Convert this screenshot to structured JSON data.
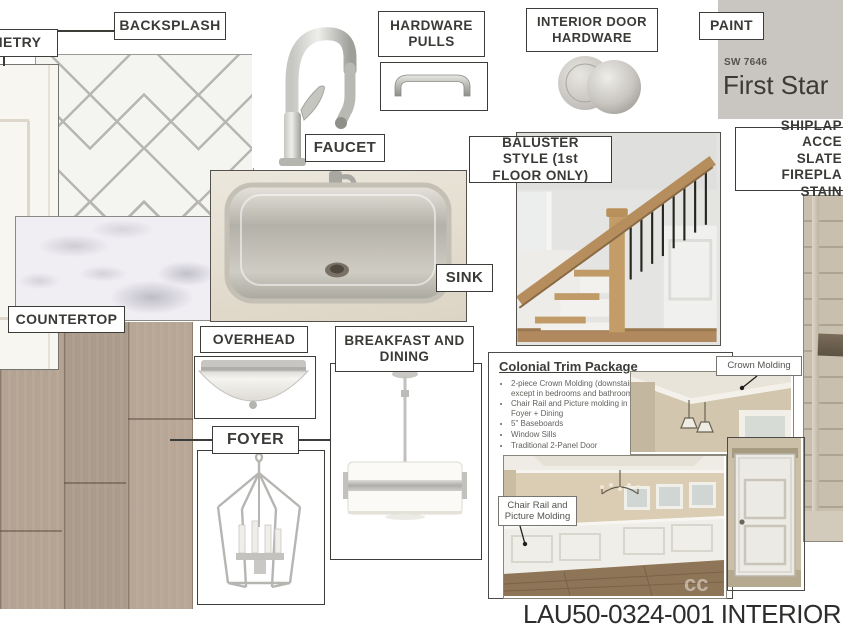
{
  "labels": {
    "cabinetry": "CABINETRY",
    "backsplash": "BACKSPLASH",
    "hardware_pulls": "HARDWARE PULLS",
    "interior_door_hardware": "INTERIOR DOOR HARDWARE",
    "paint": "PAINT",
    "faucet": "FAUCET",
    "baluster": "BALUSTER STYLE (1st FLOOR ONLY)",
    "shiplap_lines": [
      "SHIPLAP ACCE",
      "SLATE FIREPLA",
      "STAIN"
    ],
    "sink": "SINK",
    "countertop": "COUNTERTOP",
    "overhead": "OVERHEAD",
    "breakfast_dining": "BREAKFAST AND DINING",
    "foyer": "FOYER"
  },
  "paint": {
    "code": "SW 7646",
    "name": "First Star"
  },
  "trim_package": {
    "title": "Colonial Trim Package",
    "bullets": [
      "2-piece Crown Molding (downstairs except in bedrooms and bathrooms)",
      "Chair Rail and Picture molding in Foyer + Dining",
      "5\" Baseboards",
      "Window Sills",
      "Traditional 2-Panel Door"
    ],
    "crown_tag": "Crown Molding",
    "chair_rail_tag": "Chair Rail and Picture Molding"
  },
  "dining_photo": {
    "watermark": "cc"
  },
  "footer": {
    "code": "LAU50-0324-001 INTERIOR"
  },
  "colors": {
    "label_border": "#3c3c39",
    "paint_swatch": "#c9c6c2",
    "tile_grout": "#b7b6b3",
    "wood_floor": "#b1a090",
    "shiplap_wall": "#c8bfae",
    "stair_wood": "#b68e5e"
  }
}
